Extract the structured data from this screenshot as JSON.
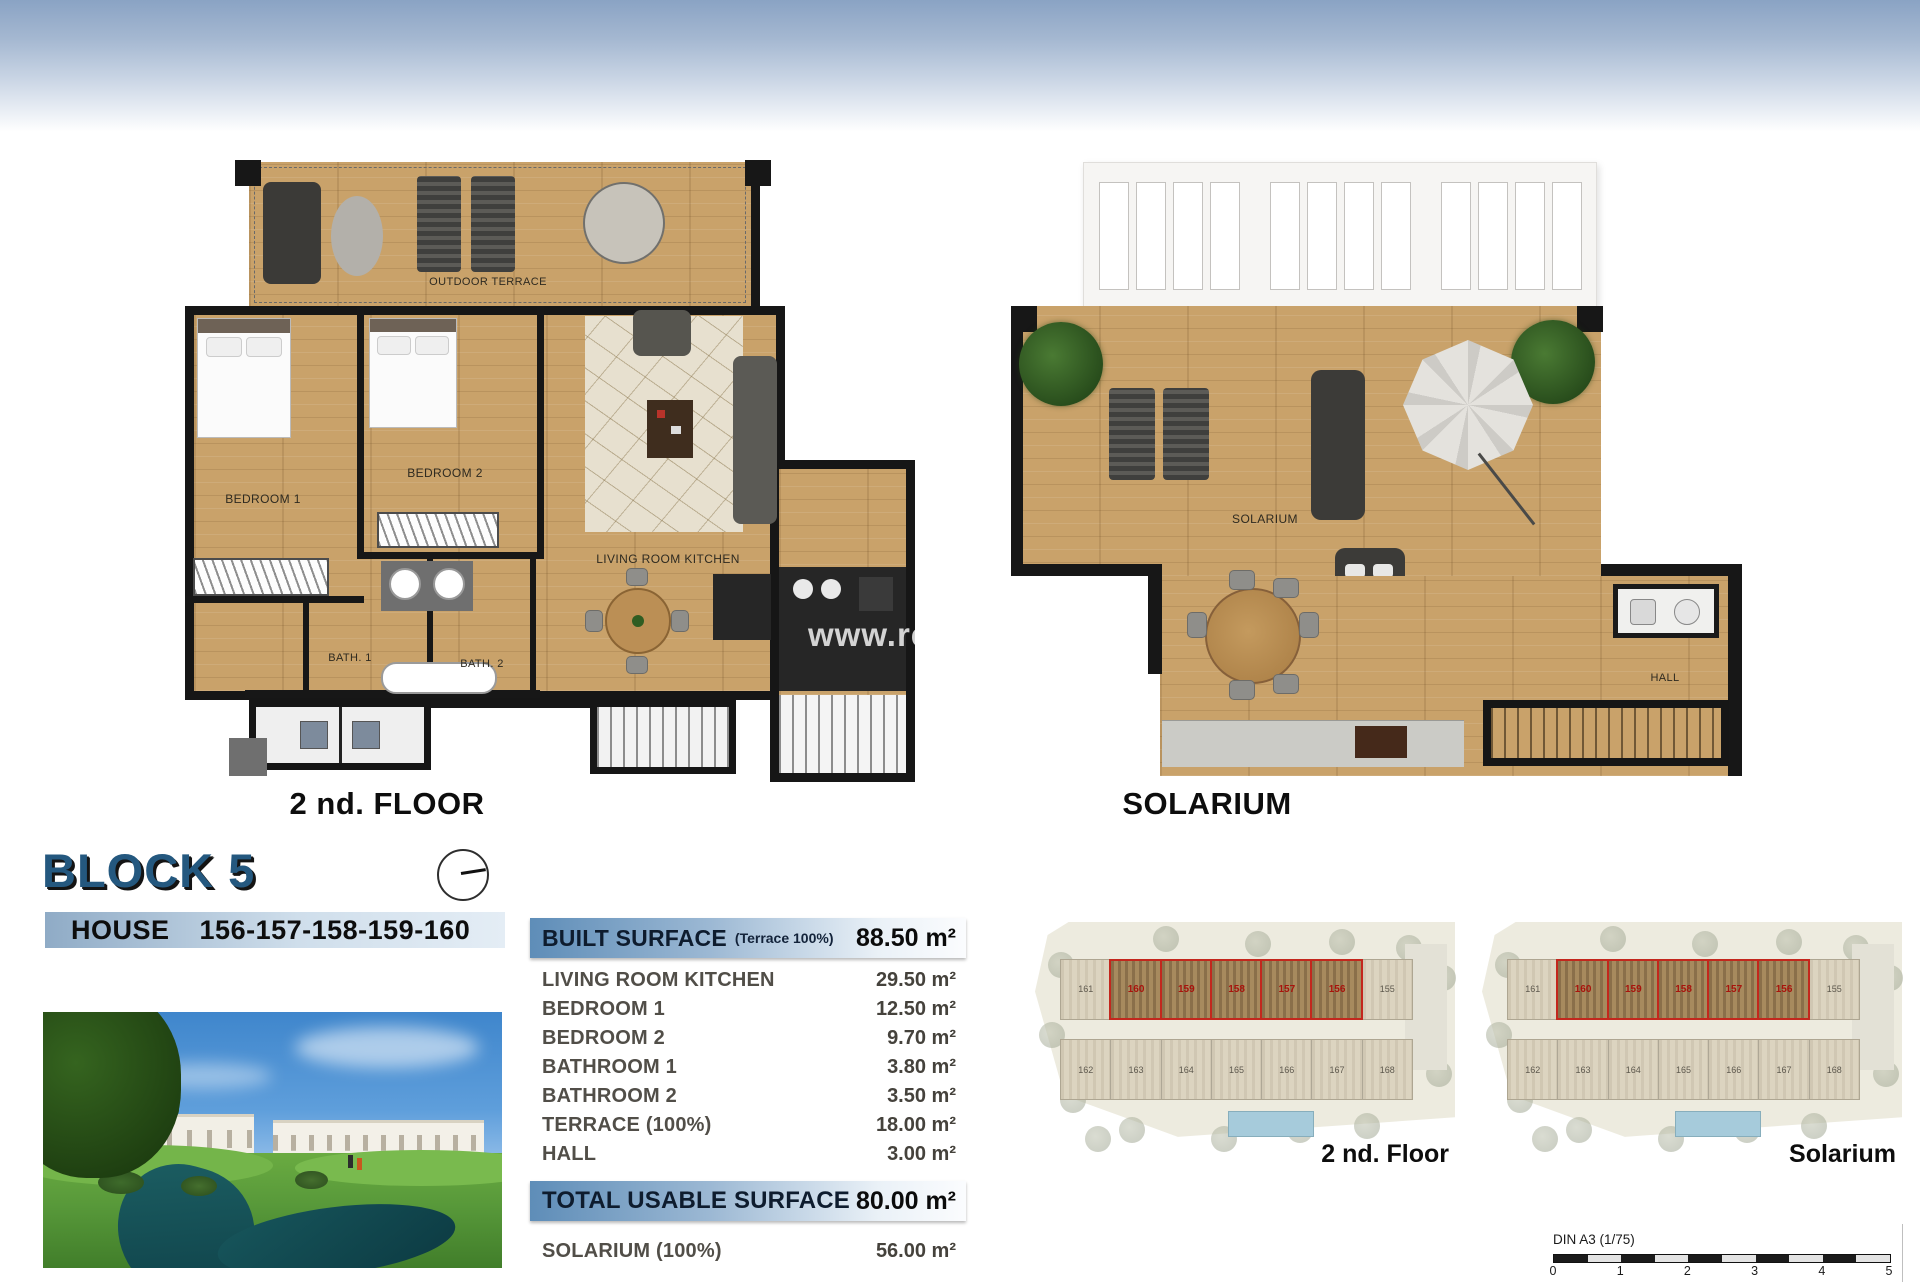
{
  "page": {
    "watermark": "www.re"
  },
  "floor_plan": {
    "caption": "2 nd. FLOOR",
    "labels": {
      "outdoor_terrace": "OUTDOOR TERRACE",
      "bedroom1": "BEDROOM 1",
      "bedroom2": "BEDROOM 2",
      "living": "LIVING ROOM KITCHEN",
      "bath1": "BATH. 1",
      "bath2": "BATH. 2"
    }
  },
  "solarium_plan": {
    "caption": "SOLARIUM",
    "labels": {
      "solarium": "SOLARIUM",
      "hall": "HALL"
    }
  },
  "block": {
    "title": "BLOCK 5",
    "house_label": "HOUSE",
    "house_numbers": "156-157-158-159-160"
  },
  "surface_table": {
    "header": {
      "label": "BUILT SURFACE",
      "note": "(Terrace 100%)",
      "value": "88.50 m²"
    },
    "rows": [
      {
        "label": "LIVING ROOM KITCHEN",
        "value": "29.50 m²"
      },
      {
        "label": "BEDROOM 1",
        "value": "12.50 m²"
      },
      {
        "label": "BEDROOM 2",
        "value": "9.70 m²"
      },
      {
        "label": "BATHROOM 1",
        "value": "3.80 m²"
      },
      {
        "label": "BATHROOM 2",
        "value": "3.50 m²"
      },
      {
        "label": "TERRACE (100%)",
        "value": "18.00 m²"
      },
      {
        "label": "HALL",
        "value": "3.00 m²"
      }
    ],
    "total": {
      "label": "TOTAL USABLE SURFACE",
      "value": "80.00 m²"
    },
    "extra": {
      "label": "SOLARIUM (100%)",
      "value": "56.00 m²"
    }
  },
  "site_plans": [
    {
      "caption": "2 nd. Floor"
    },
    {
      "caption": "Solarium"
    }
  ],
  "site_layout": {
    "top_row_end_left": "161",
    "top_row_highlight": [
      "160",
      "159",
      "158",
      "157",
      "156"
    ],
    "top_row_end_right": "155",
    "bottom_row": [
      "162",
      "163",
      "164",
      "165",
      "166",
      "167",
      "168"
    ]
  },
  "scale_bar": {
    "label": "DIN A3 (1/75)",
    "ticks": [
      "0",
      "1",
      "2",
      "3",
      "4",
      "5"
    ]
  },
  "colors": {
    "accent_blue": "#24587f",
    "bar_gradient_start": "#5e8db8",
    "wood": "#c9a26a",
    "wall": "#171717",
    "highlight_red": "#c3271d"
  }
}
